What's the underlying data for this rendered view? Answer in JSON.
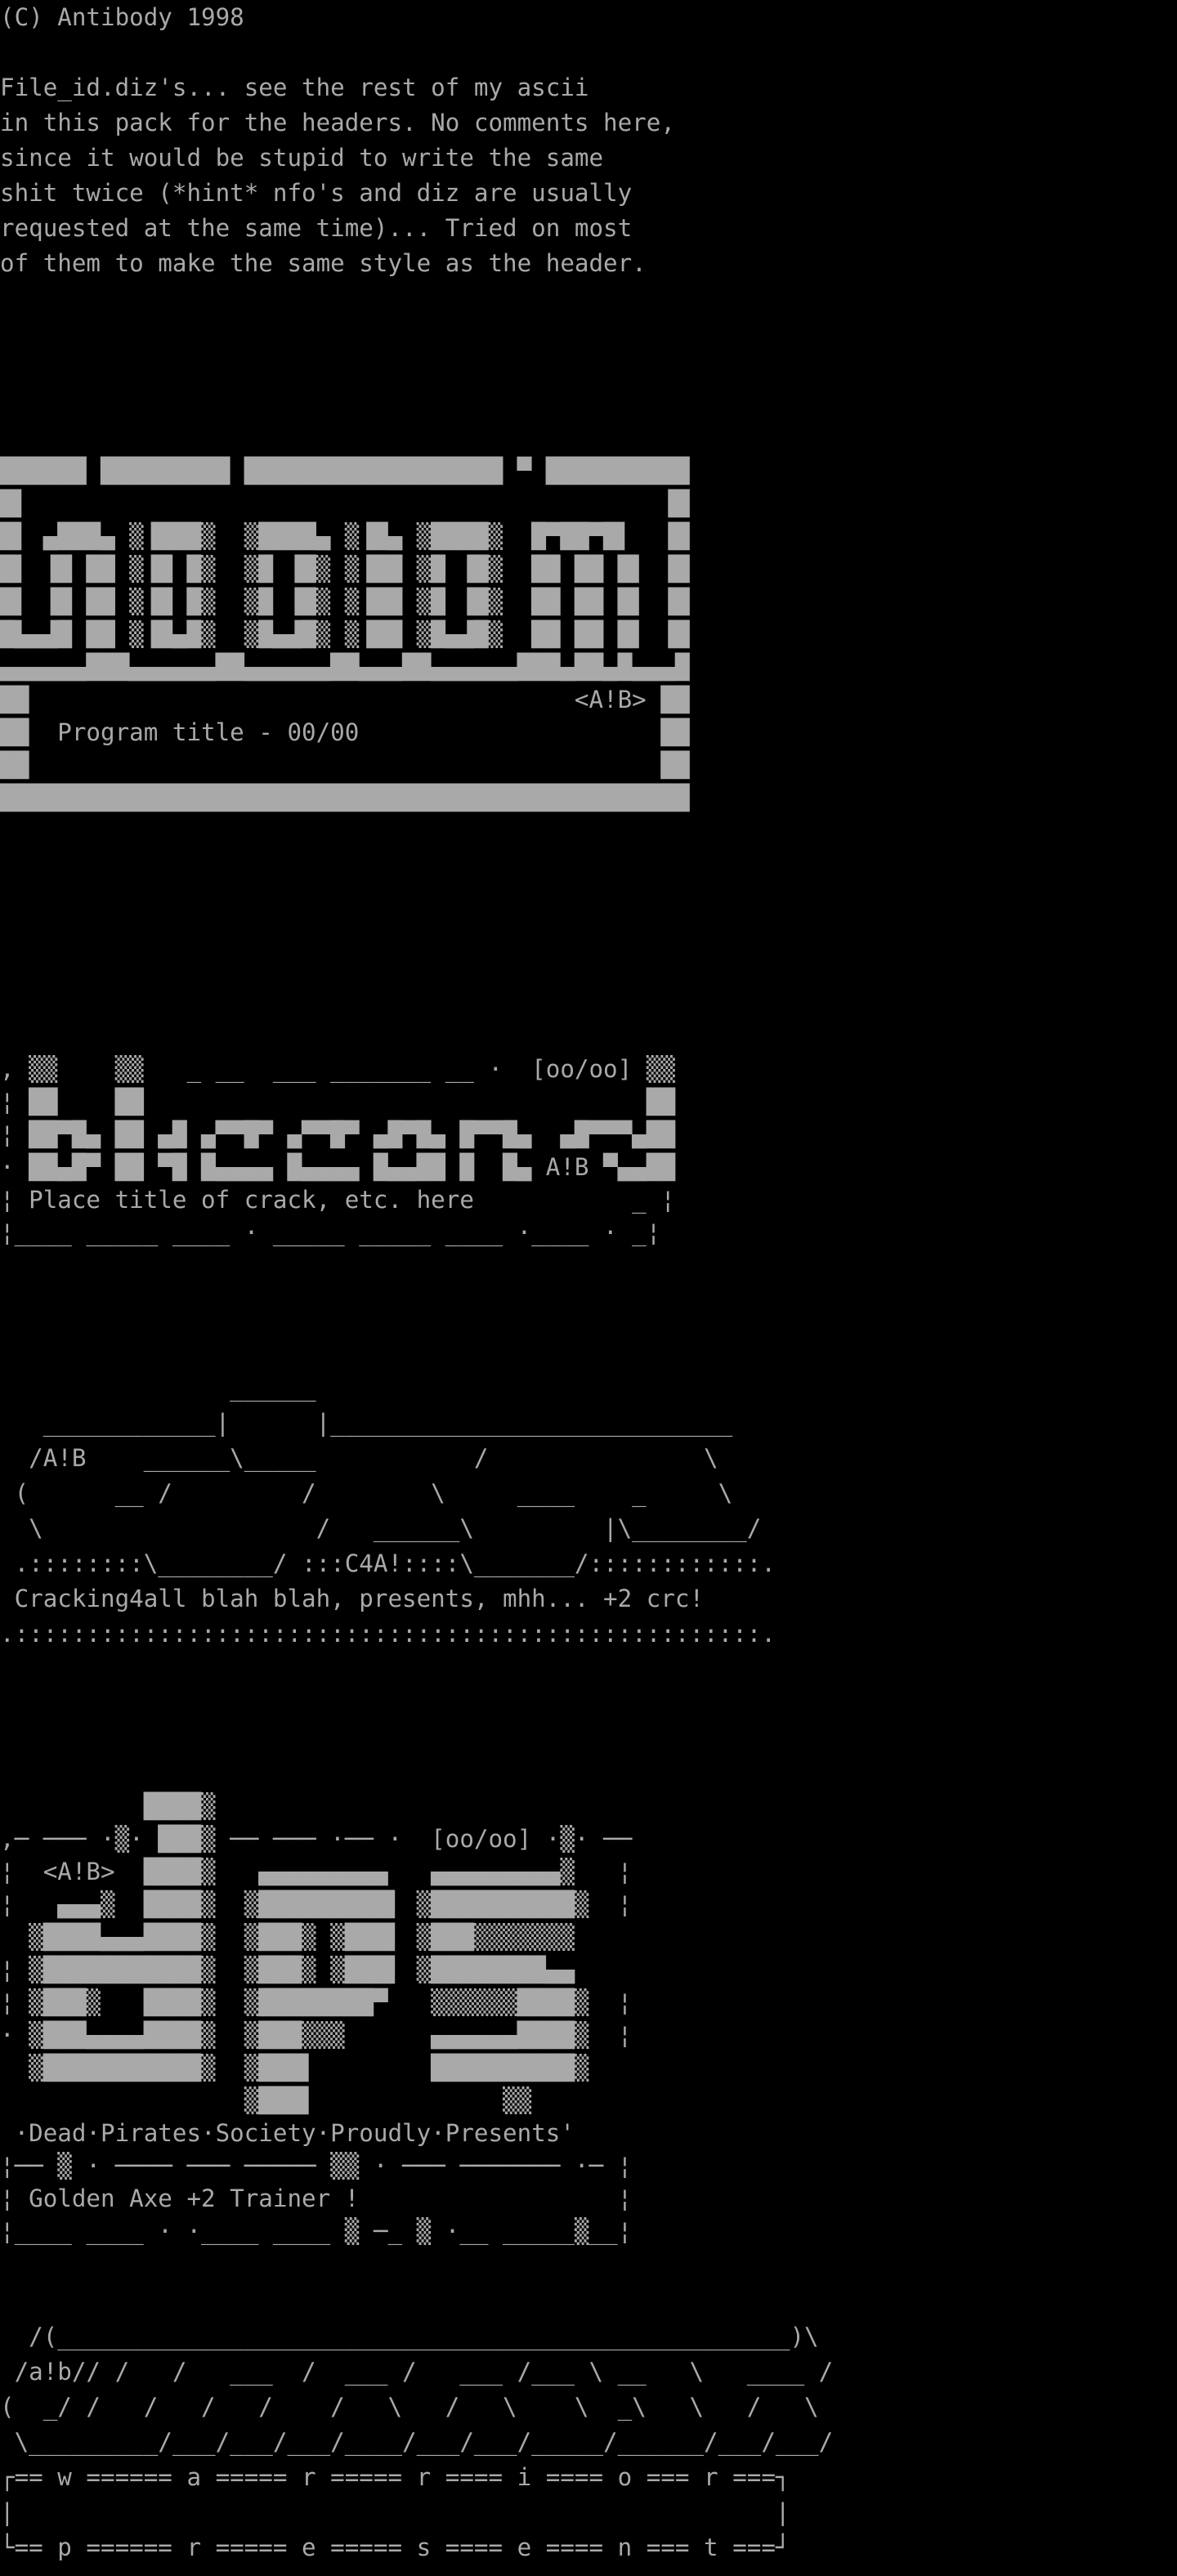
{
  "page": {
    "background_color": "#000000",
    "text_color": "#a9a9a9",
    "kind": "ascii-art pack file viewed in terminal"
  },
  "header": {
    "copyright": "(C) Antibody 1998"
  },
  "intro": {
    "lines": [
      "File_id.diz's... see the rest of my ascii",
      "in this pack for the headers. No comments here,",
      "since it would be stupid to write the same",
      "shit twice (*hint* nfo's and diz are usually",
      "requested at the same time)... Tried on most",
      "of them to make the same style as the header."
    ]
  },
  "logo_unnamed": {
    "group_tag": "<A!B>",
    "title_placeholder": "Program title - 00/00",
    "counter": "00/00",
    "art": [
      "██████ █████████ ██████████████████ ▀ ██████████",
      "█▌                                            ▐█",
      "█▌ ▄███▄ ▒▐███▒  ▒████▄ ▒▐█▄ ▒████▒  █▀██▀█▌  ▐█",
      "█▌ ▐█ ██ ▒▐█ █▒  ▒█ ▐█▒ ▒▐██ ▒█ ▐█▒  ██ ██ █▌ ▐█",
      "█▌ ▐█ ██ ▒▐█ █▒  ▒█ ▐█▒ ▒▐██ ▒█ ▐█▒  ██ ██ █▌ ▐█",
      "█▙▄▟█ ██ ▒▐█▄█▒  ▒█▄▟█▒ ▒▐██ ▒█▄▟█▒  ██ ██ █▌ ▐█",
      "▄▄▄▄▄▄███▄▄▄▄▄▄██▄▄▄▄▄▄██▄▄▄██▄▄▄▄▄▄███▄██▄█▄▄▄█",
      "██                                      <A!B> ██",
      "██  Program title - 00/00                     ██",
      "██                                            ██",
      "████████████████████████████████████████████████"
    ]
  },
  "logo_blizzard": {
    "group_name": "blizzard",
    "group_tag": "A!B",
    "counter": "[oo/oo]",
    "title_placeholder": "Place title of crack, etc. here",
    "art": [
      ", ▒▒    ▒▒   _ __  ___ _______ __ ·  [oo/oo] ▒▒",
      "¦ ██    ██                                   ██",
      "¦ ██▀█▄ ██ ▄█ ▄▀▀█▀ ▄▀▀█▀ ▄█▀█▄ █▀▀█▄  ▄█▀▀▀▄██",
      "· ██▄█▀ ██ ▀█ █▄▄▄▄ █▄▄▄▄ █▄▄██ █  █▄ A!B ▀▄▄██",
      "¦ Place title of crack, etc. here           _ ¦",
      "¦____ _____ ____ · _____ _____ ____ ·____ · _¦"
    ]
  },
  "logo_c4a": {
    "group_name": "C4A!",
    "group_tag": "A!B",
    "tagline": "Cracking4all blah blah, presents, mhh... +2 crc!",
    "art": [
      "                ______",
      "   ____________|      |____________________________",
      "  /A!B    ______\\_____           /               \\",
      " (      __ /         /        \\     ____    _     \\",
      "  \\                   /   ______\\         |\\________/",
      " .::::::::\\________/ :::C4A!::::\\_______/::::::::::::.",
      " Cracking4all blah blah, presents, mhh... +2 crc!",
      ".::::::::::::::::::::::::::::::::::::::::::::::::::::."
    ]
  },
  "logo_dps": {
    "group_name": "dps",
    "group_tag": "<A!B>",
    "counter": "[oo/oo]",
    "presents_line": "·Dead·Pirates·Society·Proudly·Presents'",
    "release_title": "Golden Axe +2 Trainer !",
    "art": [
      "          ████▒",
      ",─ ─── ·▒· ███▒ ── ─── ·── ·  [oo/oo] ·▒· ──",
      "¦  <A!B>  ████▒   ▄▄▄▄▄▄▄▄▄   ▄▄▄▄▄▄▄▄▄▒   ¦",
      "¦   ▄▄▄▒  ████▒  ▒█████████▌ ▒██████████▒  ¦",
      "  ▒████▄▄▄████▒  ▒███▒ ▒███▌ ▒███▒▒▒▒▒▒▒   ",
      "¦ ▒███████████▒  ▒███▒ ▒███▌ ▒████████▄▄   ",
      "¦ ▒███▒   ████▒  ▒████████▀   ▒▒▒▒▒▒████▒  ¦",
      "· ▒███▄▄▄▄████▒  ▒███▒▒▒      ▄▄▄▄▄▄████▒  ¦",
      "  ▒███████████▒  ▒███▌        ██████████▒   ",
      "                 ▒███▌             ▒▒       ",
      " ·Dead·Pirates·Society·Proudly·Presents'    ",
      "¦── ▒ · ──── ─── ───── ▒▒ · ─── ─────── ·─ ¦",
      "¦ Golden Axe +2 Trainer !                  ¦",
      "¦____ ____ · ·____ ____ ▒ ─_ ▒ ·__ _____▒__¦"
    ]
  },
  "logo_warrior": {
    "group_name_top": "warrior",
    "group_name_bottom": "present",
    "group_tag": "a!b",
    "art": [
      "  /(___________________________________________________)\\",
      " /a!b// /   /   ___  /  ___ /   ___ /___ \\ __   \\   ____ /",
      "(  _/ /   /   /   /    /   \\   /   \\    \\  _\\   \\   /   \\",
      " \\_________/___/___/___/____/___/___/_____/______/___/___/",
      "┌== w ====== a ===== r ===== r ==== i ==== o === r ===┐",
      "|                                                     |",
      "└== p ====== r ===== e ===== s ==== e ==== n === t ===┘"
    ]
  }
}
